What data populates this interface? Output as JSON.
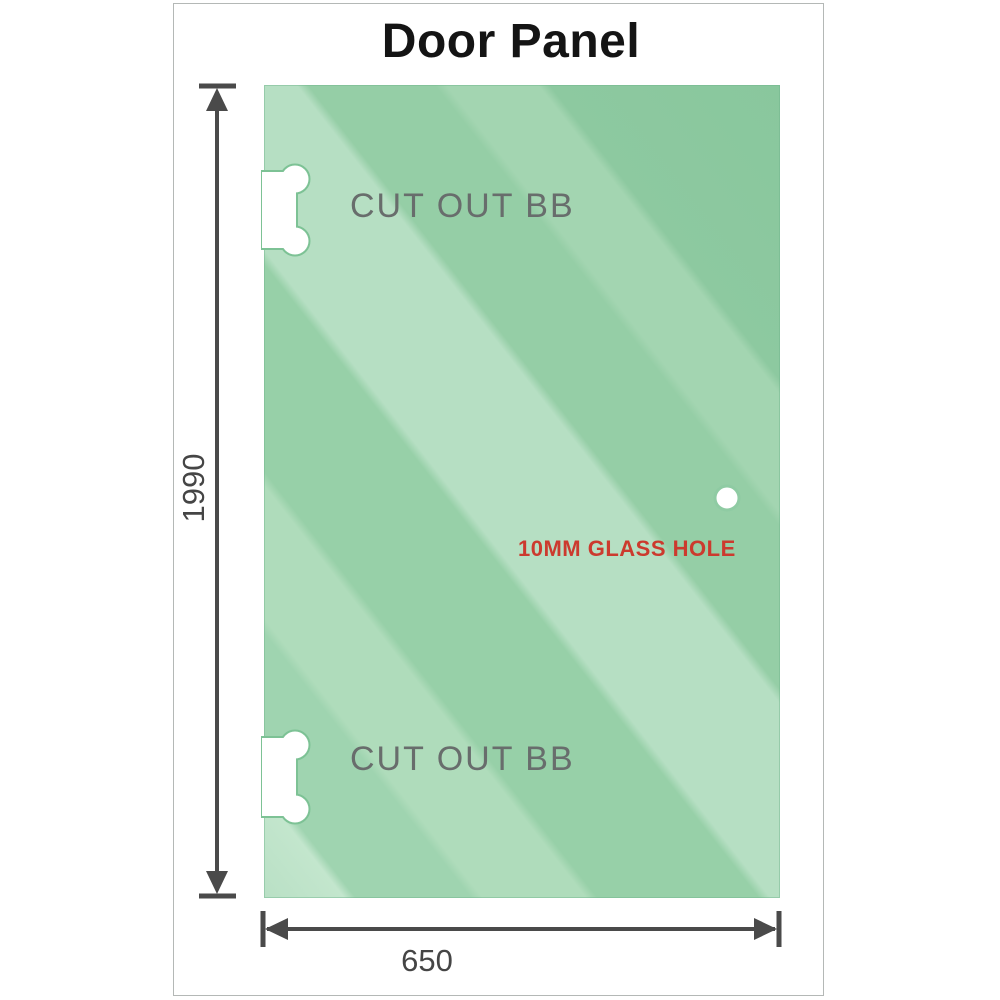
{
  "title": "Door Panel",
  "labels": {
    "cutout_top": "CUT OUT BB",
    "cutout_bottom": "CUT OUT BB",
    "glass_hole": "10MM GLASS HOLE",
    "height": "1990",
    "width": "650"
  },
  "colors": {
    "glass_base": "#97d0a8",
    "glass_light_band": "#b6dfc3",
    "glass_dark": "#89c79d",
    "cutout_outline": "#7dc295",
    "dimension_lines": "#4a4a4a",
    "cutout_text": "#686d6c",
    "hole_text": "#cc3a2e",
    "dim_text": "#454545",
    "title_text": "#141414",
    "frame_border": "#b4b8b6"
  }
}
